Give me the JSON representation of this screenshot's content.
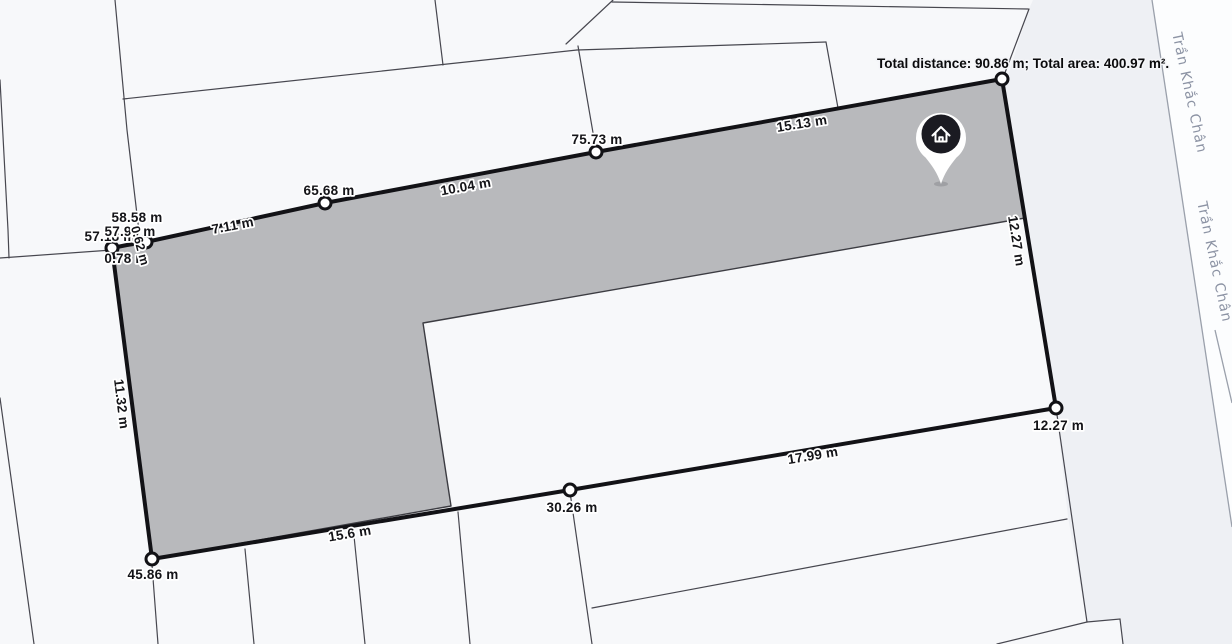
{
  "summary": {
    "text": "Total distance: 90.86 m; Total area: 400.97 m².",
    "total_distance": "90.86 m",
    "total_area": "400.97 m²"
  },
  "street": {
    "name": "Trần Khắc Chân"
  },
  "measurement": {
    "unit": "m",
    "segments_m": [
      12.27,
      17.99,
      15.6,
      11.32,
      0.78,
      0.62,
      7.11,
      10.04,
      15.13
    ],
    "cumulative_m": [
      12.27,
      30.26,
      45.86,
      57.18,
      57.96,
      58.58,
      65.68,
      75.73,
      90.86
    ],
    "total_distance_m": 90.86,
    "total_area_m2": 400.97
  },
  "labels": {
    "seg_right": "12.27 m",
    "cum_right": "12.27 m",
    "seg_bottom_right": "17.99 m",
    "cum_bottom_mid": "30.26 m",
    "seg_bottom_left": "15.6 m",
    "cum_bottom_left": "45.86 m",
    "seg_left": "11.32 m",
    "cum_cluster_1": "57.18 m",
    "cum_cluster_2": "57.96 m",
    "cum_cluster_3": "58.58 m",
    "seg_cluster_1": "0.78 m",
    "seg_cluster_2": "0.62 m",
    "seg_top_1": "7.11 m",
    "cum_top_1": "65.68 m",
    "seg_top_2": "10.04 m",
    "cum_top_2": "75.73 m",
    "seg_top_3": "15.13 m"
  },
  "pin": {
    "icon": "home-icon"
  },
  "colors": {
    "area_fill": "#b8b9bc",
    "measure_line": "#121216",
    "parcel_line": "#47474f",
    "open_zone": "#eef0f4",
    "street_text": "#8c93a4",
    "pin_dark": "#1b1b22",
    "background": "#f7f8fa"
  }
}
